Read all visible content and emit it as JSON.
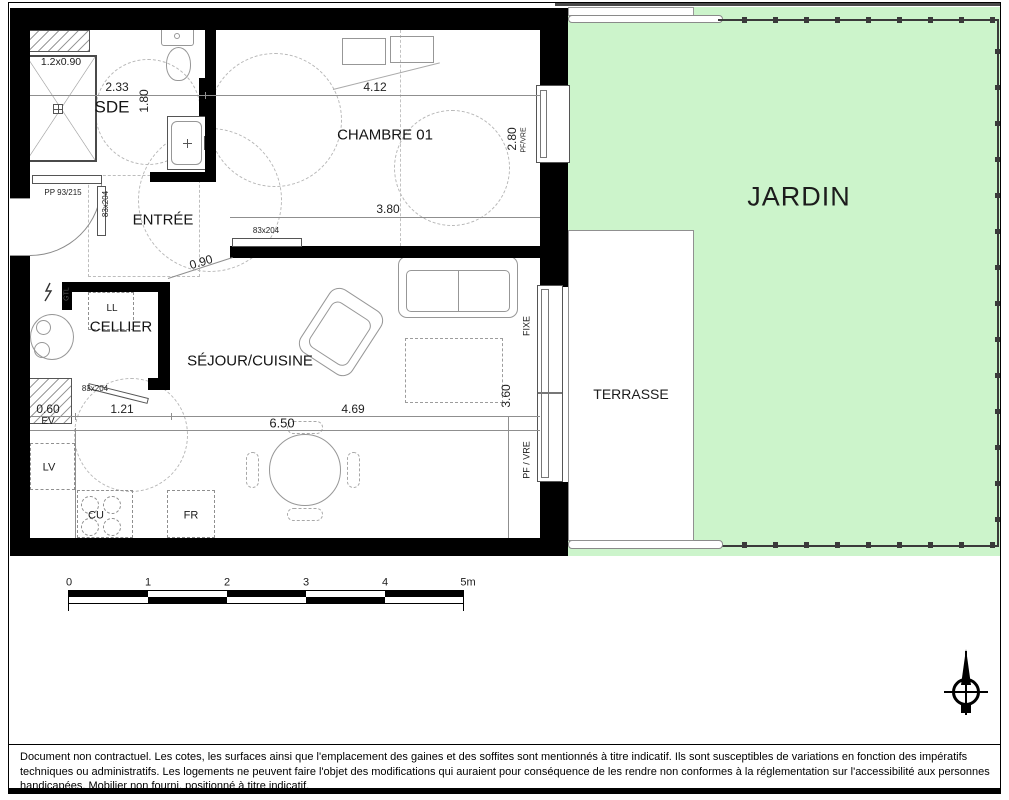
{
  "plan": {
    "rooms": {
      "sde": "SDE",
      "entree": "ENTRÉE",
      "chambre": "CHAMBRE 01",
      "cellier": "CELLIER",
      "sejour": "SÉJOUR/CUISINE",
      "terrasse": "TERRASSE",
      "jardin": "JARDIN"
    },
    "dims": {
      "shower": "1.2x0.90",
      "sde_width": "2.33",
      "sde_depth": "1.80",
      "chambre_width": "4.12",
      "chambre_depth": "2.80",
      "entree_width": "3.80",
      "passage": "0.90",
      "kitchen_a": "0.60",
      "kitchen_b": "1.21",
      "sejour_width": "4.69",
      "sejour_total": "6.50",
      "sejour_depth": "3.60"
    },
    "doors": {
      "entry": "PP 93/215",
      "sde": "83x204",
      "chambre": "83x204",
      "cellier": "83x204"
    },
    "windows": {
      "chambre": "PF/VRE",
      "fixed": "FIXE",
      "french": "PF / VRE"
    },
    "fixtures": {
      "washer": "LL",
      "electrical": "GTL",
      "sink": "EV",
      "dishwasher": "LV",
      "cooktop": "CU",
      "fridge": "FR"
    }
  },
  "scale_bar": {
    "labels": [
      "0",
      "1",
      "2",
      "3",
      "4",
      "5m"
    ]
  },
  "footer": {
    "disclaimer": "Document non contractuel. Les cotes, les surfaces ainsi que l'emplacement des gaines et des soffites sont mentionnés à titre indicatif. Ils sont susceptibles de variations en fonction des impératifs techniques ou administratifs. Les logements ne peuvent faire l'objet des modifications qui auraient pour conséquence de les rendre non conformes à la réglementation sur l'accessibilité aux personnes handicapées. Mobilier non fourni, positionné à titre indicatif."
  },
  "colors": {
    "garden": "#ccf4cb",
    "wall": "#000000",
    "fence": "#3a3a3a"
  }
}
